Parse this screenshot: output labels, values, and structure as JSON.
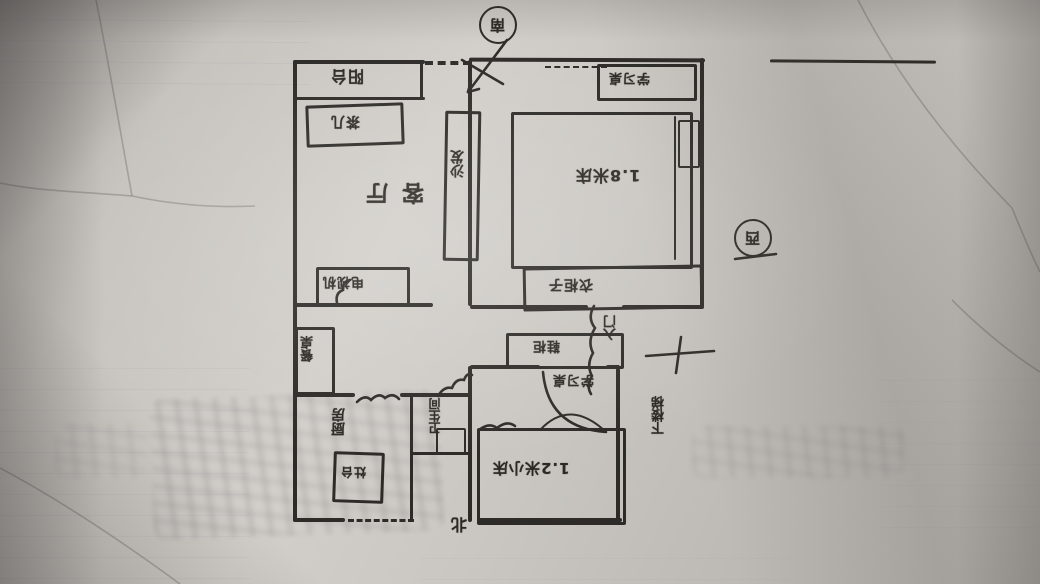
{
  "plan": {
    "compass": {
      "south": "南",
      "west": "西",
      "north": "北"
    },
    "entrance": {
      "label": "入门"
    },
    "stairwell": {
      "label": "下楼梯"
    },
    "rooms": {
      "balcony": {
        "name": "阳台"
      },
      "living_room": {
        "name": "客厅",
        "furniture": {
          "tea_table": "茶几",
          "sofa": "沙发",
          "tv": "电视机",
          "dining_table": "餐桌"
        }
      },
      "kitchen": {
        "name": "厨房",
        "furniture": {
          "stove": "灶台"
        }
      },
      "bathroom": {
        "name": "卫生间"
      },
      "master_bedroom": {
        "furniture": {
          "desk": "学习桌",
          "bed": "1.8米床",
          "wardrobe": "衣柜子"
        }
      },
      "small_bedroom": {
        "furniture": {
          "desk": "学习桌",
          "bed": "1.2米小床"
        }
      },
      "entry_hall": {
        "furniture": {
          "shoe_cabinet": "鞋柜"
        }
      }
    },
    "colors": {
      "paper": "#c6c3be",
      "ink": "#2d2b27",
      "grid_line": "#7e93ab"
    }
  }
}
